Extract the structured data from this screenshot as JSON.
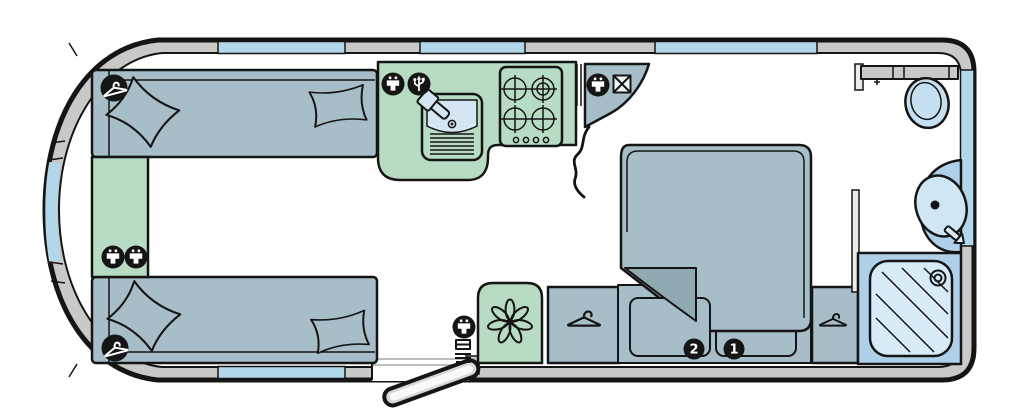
{
  "diagram": {
    "type": "caravan-floorplan",
    "badges": [
      {
        "name": "drawer-badge-2",
        "label": "2"
      },
      {
        "name": "drawer-badge-1",
        "label": "1"
      }
    ],
    "colors": {
      "outline": "#151515",
      "wall": "#c9c9c7",
      "window": "#b3d7ea",
      "floor": "#ffffff",
      "upholstery": "#a7bdc7",
      "upholstery_dark": "#8fabb1",
      "worktop_green": "#b7dcc3",
      "fixture_blue": "#aed0e8",
      "fixture_blue_light": "#cfe6f5",
      "door_grey": "#d8d8d6",
      "icon_black": "#151515",
      "badge_text": "#ffffff"
    },
    "icons": [
      "mains-socket-icon",
      "usb-socket-icon",
      "tv-aerial-socket-icon",
      "coat-hanger-icon",
      "fan-icon"
    ],
    "features": [
      "front-lounge-sofas",
      "scatter-cushions",
      "front-chest",
      "kitchen-sink",
      "kitchen-tap",
      "four-burner-hob",
      "corner-tv-unit",
      "divider-curtain",
      "blown-air-heater",
      "entrance-door",
      "wardrobes",
      "island-bed",
      "under-bed-drawers",
      "washroom-toilet",
      "washbasin",
      "basin-tap",
      "shower-cubicle"
    ]
  }
}
